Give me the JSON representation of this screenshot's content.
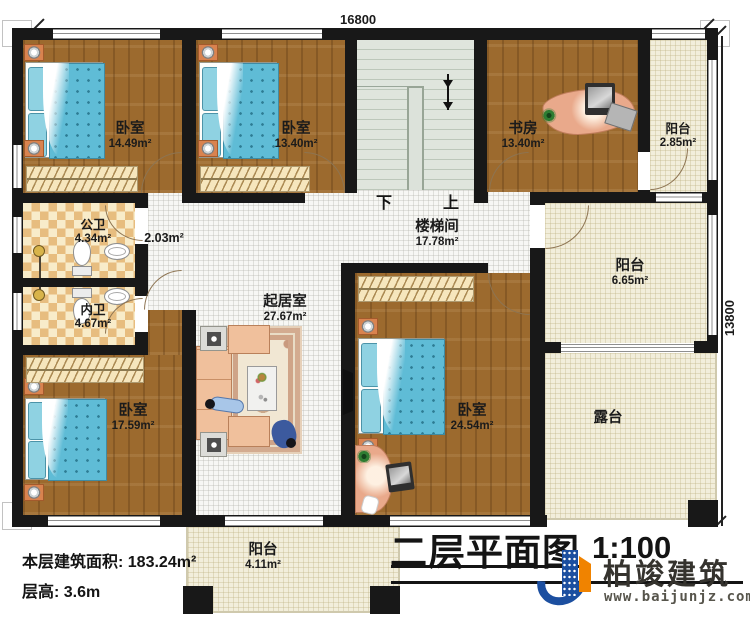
{
  "dims": {
    "width_label": "16800",
    "height_label": "13800"
  },
  "rooms": {
    "bedroom_tl": {
      "name": "卧室",
      "area": "14.49m²"
    },
    "bedroom_tm": {
      "name": "卧室",
      "area": "13.40m²"
    },
    "study": {
      "name": "书房",
      "area": "13.40m²"
    },
    "balcony_tr": {
      "name": "阳台",
      "area": "2.85m²"
    },
    "stairwell": {
      "name": "楼梯间",
      "area": "17.78m²",
      "down_label": "下",
      "up_label": "上"
    },
    "public_bath": {
      "name": "公卫",
      "area": "4.34m²"
    },
    "hall": {
      "area": "2.03m²"
    },
    "inner_bath": {
      "name": "内卫",
      "area": "4.67m²"
    },
    "living": {
      "name": "起居室",
      "area": "27.67m²"
    },
    "bedroom_bl": {
      "name": "卧室",
      "area": "17.59m²"
    },
    "bedroom_br": {
      "name": "卧室",
      "area": "24.54m²"
    },
    "balcony_right": {
      "name": "阳台",
      "area": "6.65m²"
    },
    "terrace": {
      "name": "露台"
    },
    "balcony_bottom": {
      "name": "阳台",
      "area": "4.11m²"
    }
  },
  "notes": {
    "floor_area": "本层建筑面积: 183.24m²",
    "floor_height": "层高: 3.6m"
  },
  "titleblock": {
    "title": "二层平面图",
    "scale": "1:100"
  },
  "brand": {
    "name": "柏竣建筑",
    "website": "www.baijunjz.com"
  },
  "colors": {
    "wall": "#181818",
    "wood_floor": "#9c6a2e",
    "tile": "#e7bd7f",
    "bed_blue": "#5fbcd6",
    "sofa_peach": "#f0c09c",
    "brand_blue": "#1c4fa0",
    "brand_orange": "#f08300"
  }
}
